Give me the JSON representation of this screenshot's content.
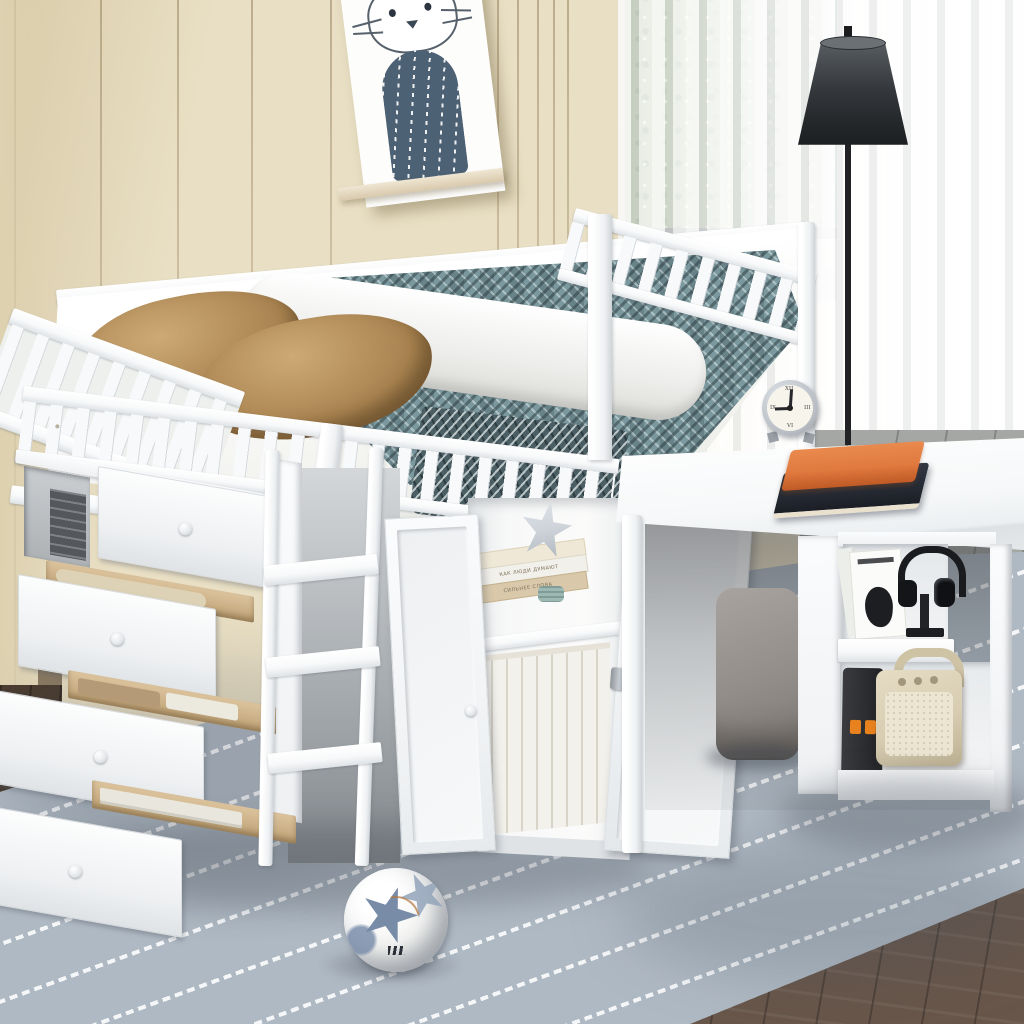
{
  "scene": {
    "description": "Kids bedroom product photo: white twin low loft bed with cascading storage drawers, ladder, bookshelf cabinet and attached rolling desk",
    "window": {
      "view": "green shrubs and stone path",
      "curtain": "white sheer",
      "sill": "dark grey"
    },
    "wall": {
      "finish": "beige vertical panelling"
    },
    "wall_art": {
      "subject": "cat illustration poster on wooden ledge",
      "body": "slate blue with white dashes"
    },
    "floor_lamp": {
      "shade": "dark grey tapered",
      "pole": "black"
    },
    "bed": {
      "color": "white",
      "pillows": 2,
      "pillow_color": "tan",
      "blanket": "teal herringbone throw",
      "bedding": "white sheet and duvet",
      "rails": "slatted guard rails"
    },
    "storage": {
      "drawer_chest": {
        "drawers": 4,
        "state": "pulled open in cascade",
        "cubby_item": "dark storage box"
      },
      "ladder": {
        "rungs": 3
      },
      "cabinet": {
        "doors": 2,
        "state": "open",
        "shelves": 2,
        "decor": [
          "silver star ornament",
          "teal candle"
        ],
        "bottom_shelf": "row of white books with one leaning"
      }
    },
    "cabinet_books": {
      "titles": [
        "КАК ЛЮДИ ДУМАЮТ",
        "СИЛЬНЕЕ СЛОВА"
      ]
    },
    "desk": {
      "items_on_top": [
        "alarm clock",
        "orange notebook",
        "black notebook"
      ],
      "side_shelf_top": [
        "fashion magazine",
        "black headphones on stand"
      ],
      "side_shelf_bottom": [
        "black power bank with orange ports",
        "cream retro speaker"
      ]
    },
    "clock": {
      "time": "9:01",
      "numerals": [
        "XII",
        "III",
        "VI",
        "IX"
      ]
    },
    "pouf": {
      "color": "grey cushioned cube"
    },
    "rug": {
      "pattern": "white dashed diagonal stripes on blue-grey"
    },
    "floor": {
      "front": "dark brown wood planks",
      "by_window": "grey tile"
    },
    "toys": [
      "soccer ball with blue star panels"
    ]
  },
  "colors": {
    "wall": "#e9dfc4",
    "wall_dark": "#d8cba8",
    "groove": "#c3b28c",
    "wall_left": "#ddd1b0",
    "jamb": "#b9ac8e",
    "green_a": "#7d9362",
    "green_b": "#5c774a",
    "green_c": "#c5d6aa",
    "path": "#b2b4ae",
    "sill": "#44484a",
    "curtain": "#f6f6f5",
    "tile": "#a5a7a4",
    "wood": "#68564a",
    "wood_dark": "#4a3c30",
    "rug": "#afb9c3",
    "rug_stripe": "#f4f6f8",
    "white_a": "#f8f9fa",
    "white_b": "#eef0f2",
    "white_c": "#dfe3e6",
    "white_d": "#cfd4d8",
    "underbed": "#9ba0a4",
    "pillow_a": "#cdaa75",
    "pillow_b": "#a98350",
    "pillow_c": "#7e6038",
    "sheet": "#f3f3f0",
    "duvet": "#ededeb",
    "teal": "#7a989e",
    "teal_dark": "#31434a",
    "teal_light": "#cfe0e0",
    "drape": "#4b5e63",
    "wood_drawer": "#dcc49e",
    "wood_drawer_dark": "#bfa276",
    "box_dark": "#54575c",
    "star": "#cdd3d9",
    "candle": "#9db8b2",
    "book_beige": "#d9c9aa",
    "book_cream": "#efe8d6",
    "book_white": "#f2f0ea",
    "lamp_a": "#5a5f63",
    "lamp_b": "#232629",
    "pole": "#202225",
    "clock_ring": "#b6bcc2",
    "clock_face": "#f7f4ec",
    "hand": "#26282b",
    "orange": "#e07a3f",
    "orange_dark": "#c05a26",
    "navy": "#262a33",
    "pouf": "#928d89",
    "pouf_dark": "#6e6965",
    "phones": "#1a1b1e",
    "bank": "#2b2c2f",
    "port": "#e8821e",
    "speaker": "#d8cdb2",
    "speaker_grille": "#ece5d2",
    "speaker_dark": "#a2967c",
    "ball_blue": "#6d81a0",
    "ball_blue2": "#93a3ba",
    "copper": "#b5773f",
    "cat_body": "#4d6175",
    "cat_line": "#57616c",
    "ledge": "#d9c9ad"
  }
}
